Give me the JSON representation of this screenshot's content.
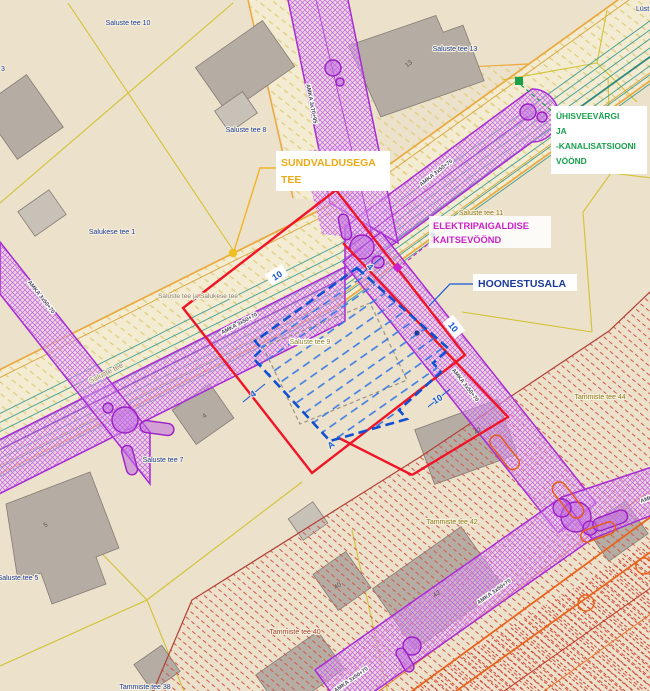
{
  "map_type": "detailplaneeringu põhijoonis (cadastral detail plan extract)",
  "callouts": {
    "sundvaldusega": {
      "line1": "SUNDVALDUSEGA",
      "line2": "TEE",
      "color": "#edaa18"
    },
    "uhisveevark": {
      "line1": "ÜHISVEEVÄRGI",
      "line2": "JA",
      "line3": "-KANALISATSIOONI",
      "line4": "VÖÖND",
      "color": "#18a04c"
    },
    "elektri": {
      "line1": "ELEKTRIPAIGALDISE",
      "line2": "KAITSEVÖÖND",
      "color": "#cc22cc"
    },
    "hoonestusala": {
      "label": "HOONESTUSALA",
      "color": "#1a3c96"
    }
  },
  "parcels": [
    {
      "text": "Saluste tee 10"
    },
    {
      "text": "Saluste tee 13"
    },
    {
      "text": "Saluste tee 8"
    },
    {
      "text": "Salukese tee 1"
    },
    {
      "text": "Saluste tee 11"
    },
    {
      "text": "Saluste tee 9"
    },
    {
      "text": "Saluste tee 7"
    },
    {
      "text": "Saluste tee 5"
    },
    {
      "text": "Tammiste tee 44"
    },
    {
      "text": "Tammiste tee 42"
    },
    {
      "text": "Tammiste tee 40"
    },
    {
      "text": "Tammiste tee 38"
    }
  ],
  "roads": [
    {
      "text": "Saluste tee"
    },
    {
      "text": "Saluste tee ja Salukese tee"
    }
  ],
  "cables": [
    {
      "text": "AMKA 3x70+95"
    },
    {
      "text": "AMKA 3x50+70"
    },
    {
      "text": "AMKA 3x50+70"
    },
    {
      "text": "AMKA 3x50+70"
    },
    {
      "text": "AMKA 3x50+70"
    },
    {
      "text": "AMKA 3x50+70"
    },
    {
      "text": "AMKA 3x50+70"
    },
    {
      "text": "AMKA 3x50+70"
    }
  ],
  "dims": [
    {
      "text": "10"
    },
    {
      "text": "10"
    },
    {
      "text": "10"
    },
    {
      "text": "4"
    },
    {
      "text": "4"
    },
    {
      "text": "A"
    }
  ],
  "building_numbers": [
    {
      "text": "13"
    },
    {
      "text": "42"
    },
    {
      "text": "42"
    },
    {
      "text": "40"
    },
    {
      "text": "4"
    },
    {
      "text": "5"
    }
  ],
  "edge_labels": [
    {
      "text": "Lüst"
    },
    {
      "text": "3"
    }
  ],
  "colors": {
    "background": "#ece1ca",
    "parcel_line": "#d2c235",
    "road_edge": "#eaa93f",
    "water_sewer": "#3f9e96",
    "electric_zone": "#a82cd4",
    "plan_boundary_red": "#f01428",
    "building_envelope_blue": "#1050d2",
    "restriction_hatch_red": "#d4574a",
    "building_fill": "#b5ada4"
  }
}
